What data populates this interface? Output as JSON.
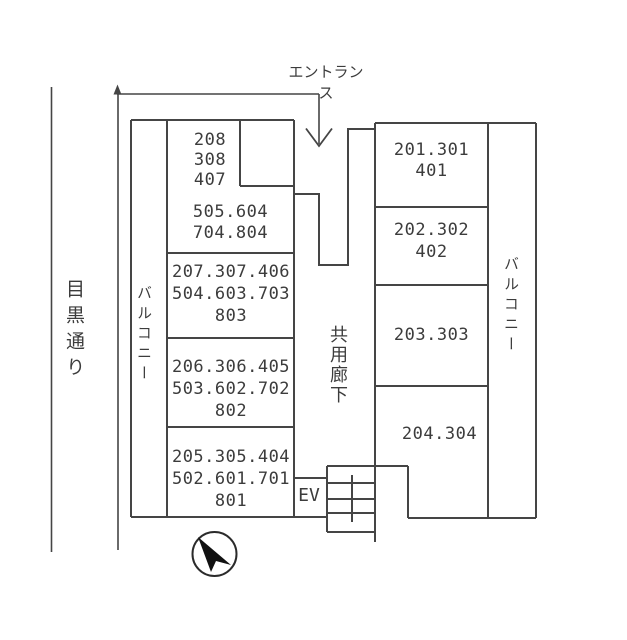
{
  "diagram_type": "building-unit-stacking-floor-plan",
  "labels": {
    "entrance": "エントランス",
    "street": "目黒通り",
    "balcony_left": "バルコニー",
    "balcony_right": "バルコニー",
    "corridor": "共用廊下",
    "elevator": "EV"
  },
  "units": {
    "left": [
      {
        "lines": [
          "208",
          "308",
          "407"
        ]
      },
      {
        "lines": [
          "505.604",
          "704.804"
        ]
      },
      {
        "lines": [
          "207.307.406",
          "504.603.703",
          "803"
        ]
      },
      {
        "lines": [
          "206.306.405",
          "503.602.702",
          "802"
        ]
      },
      {
        "lines": [
          "205.305.404",
          "502.601.701",
          "801"
        ]
      }
    ],
    "right": [
      {
        "lines": [
          "201.301",
          "401"
        ]
      },
      {
        "lines": [
          "202.302",
          "402"
        ]
      },
      {
        "lines": [
          "203.303"
        ]
      },
      {
        "lines": [
          "204.304"
        ]
      }
    ]
  },
  "colors": {
    "line": "#454545",
    "text": "#3c3c3c",
    "needle": "#111111",
    "background": "#ffffff"
  }
}
